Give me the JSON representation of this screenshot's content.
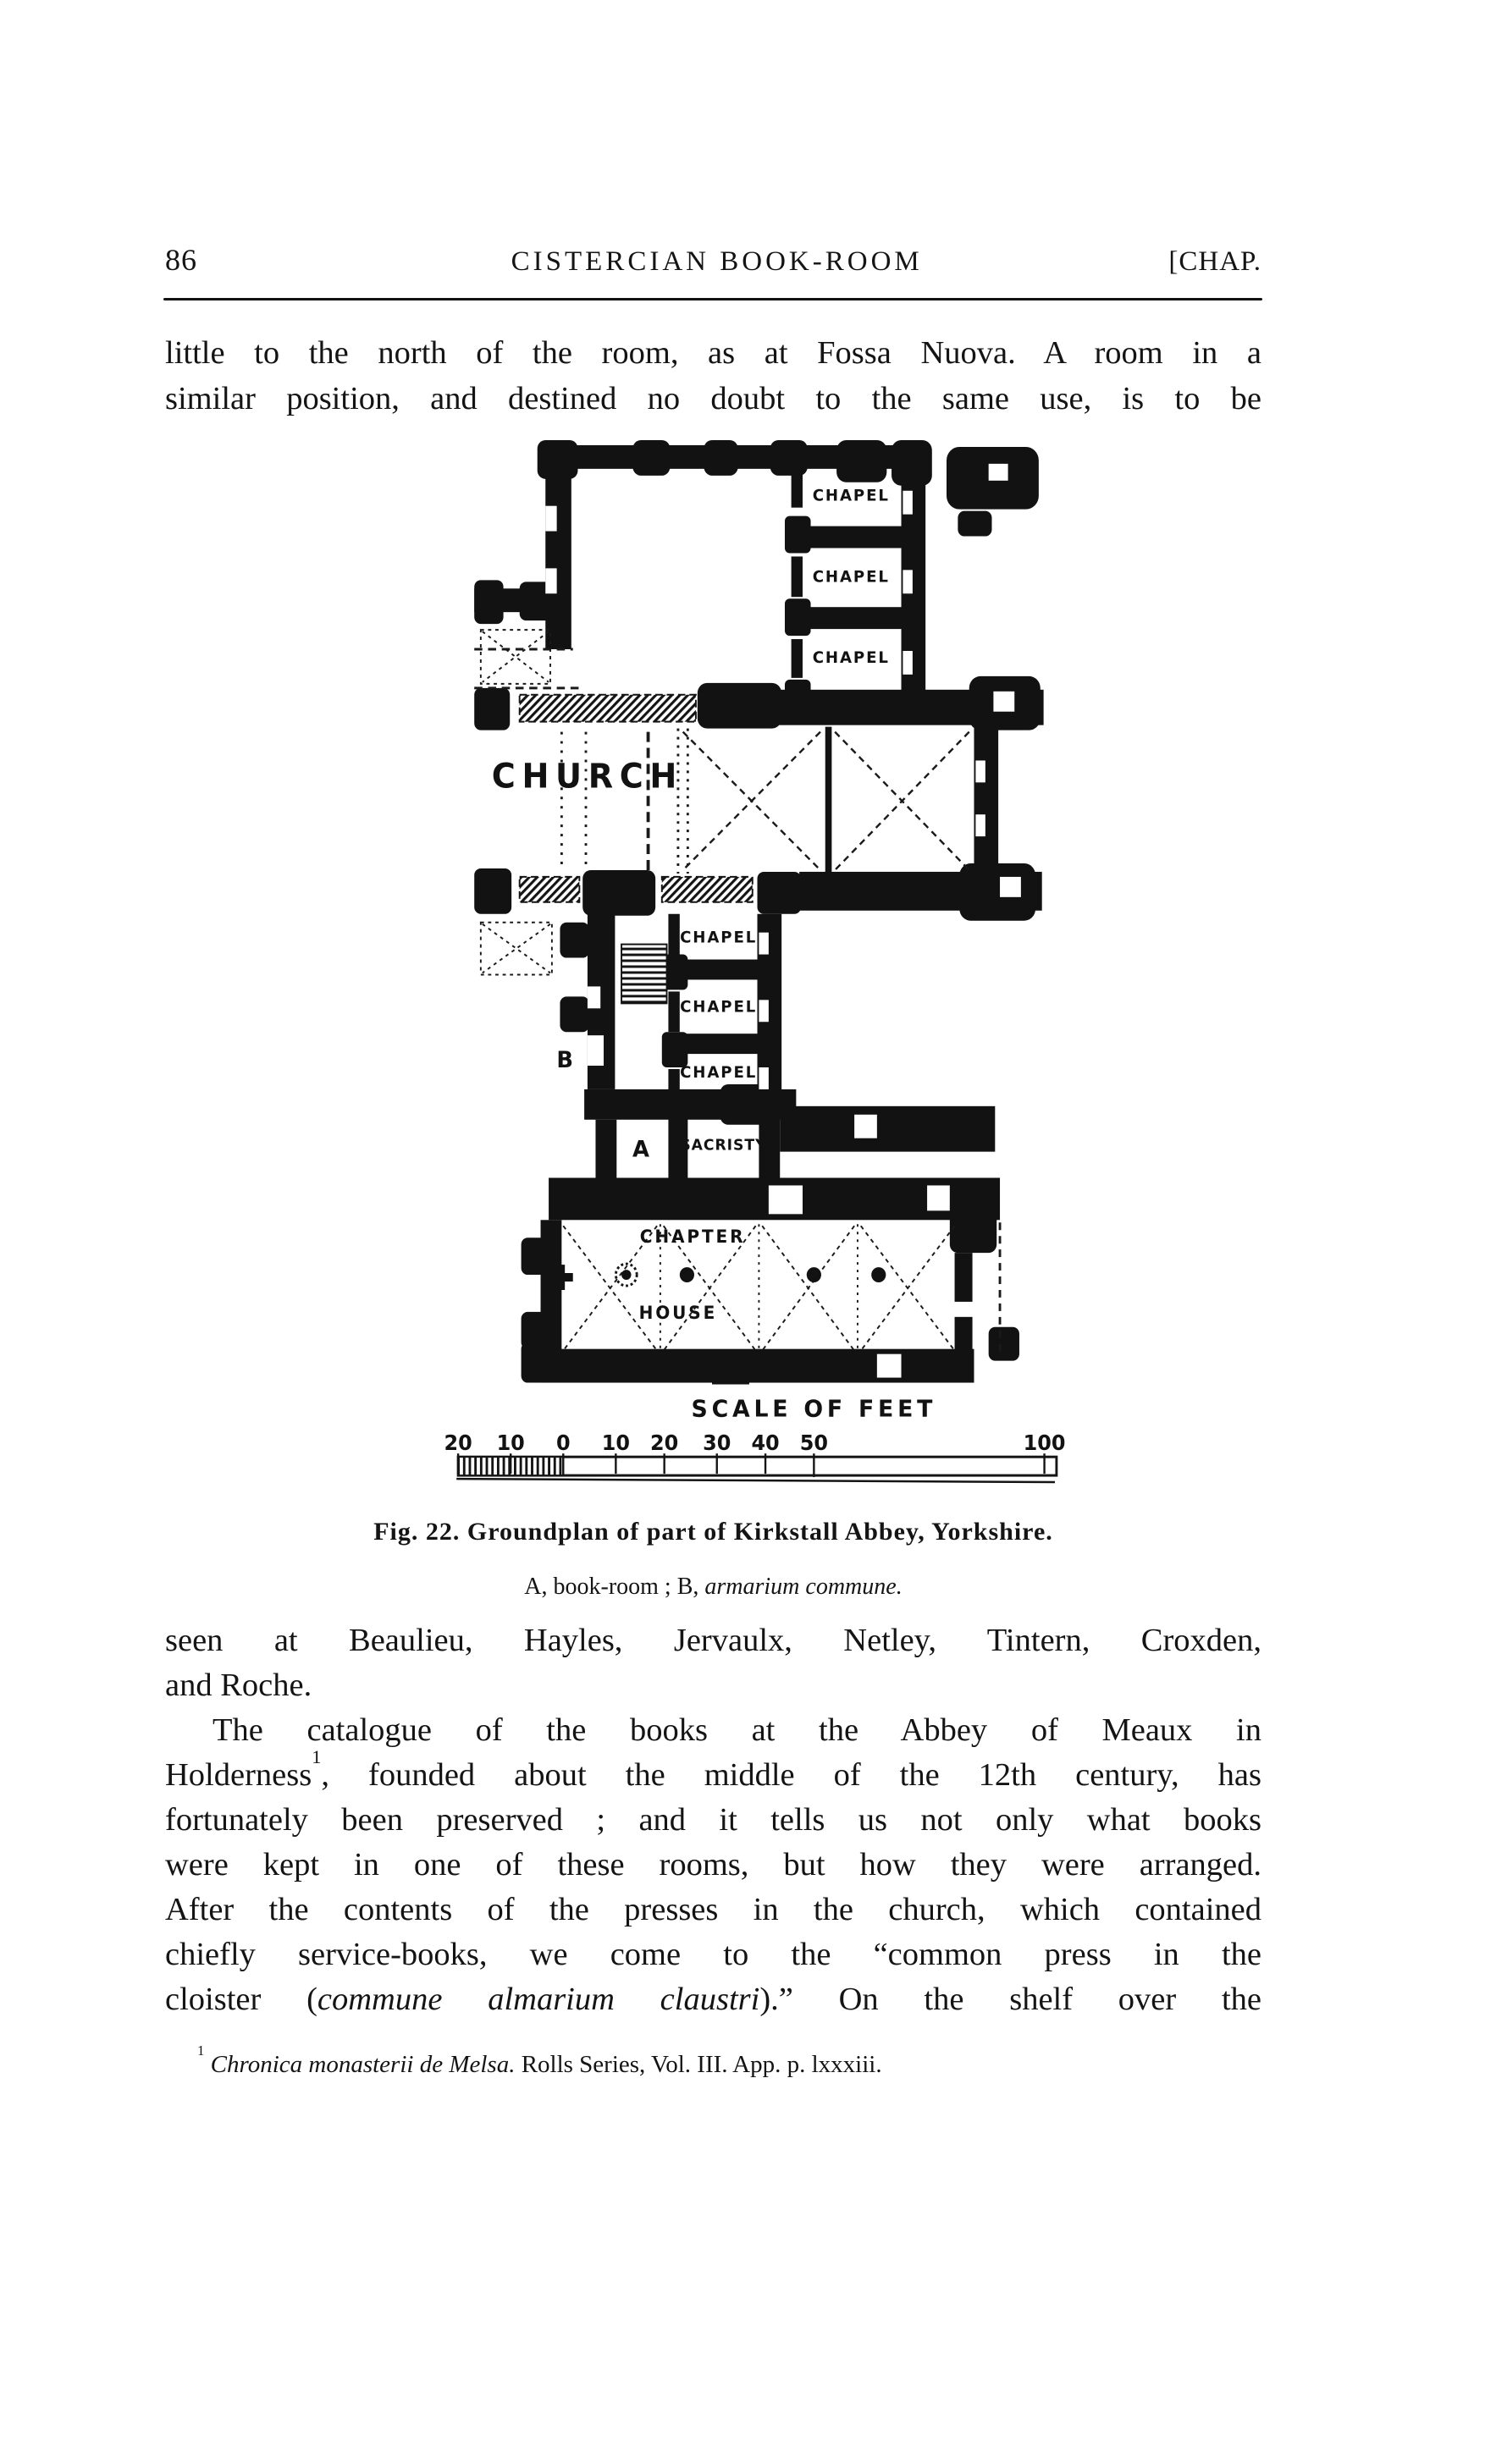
{
  "header": {
    "page_number": "86",
    "title": "CISTERCIAN BOOK-ROOM",
    "chapter_mark": "[CHAP."
  },
  "intro": {
    "lines": [
      {
        "justify": true,
        "seg": [
          {
            "t": "little to the north of the room, as at Fossa Nuova.  A room in a"
          }
        ]
      },
      {
        "justify": true,
        "seg": [
          {
            "t": "similar position, and destined no doubt to the same use, is to be"
          }
        ]
      }
    ]
  },
  "figure": {
    "plan": {
      "church": "CHURCH",
      "chapels": [
        "CHAPEL",
        "CHAPEL",
        "CHAPEL",
        "CHAPEL",
        "CHAPEL",
        "CHAPEL"
      ],
      "sacristy": "SACRISTY",
      "chapter_word1": "CHAPTER",
      "chapter_word2": "HOUSE",
      "room_a": "A",
      "room_b": "B"
    },
    "scale": {
      "title": "SCALE OF FEET",
      "ticks": [
        "20",
        "10",
        "0",
        "10",
        "20",
        "30",
        "40",
        "50",
        "100"
      ]
    },
    "caption_line1": "Fig. 22.  Groundplan of part of Kirkstall Abbey, Yorkshire.",
    "caption_line2": {
      "lines": [
        {
          "seg": [
            {
              "t": "A, book-room ;  B, "
            },
            {
              "t": "armarium commune.",
              "s": "i"
            }
          ]
        }
      ]
    }
  },
  "body": {
    "lines": [
      {
        "justify": true,
        "seg": [
          {
            "t": "seen at Beaulieu, Hayles, Jervaulx, Netley, Tintern, Croxden,"
          }
        ]
      },
      {
        "justify": false,
        "seg": [
          {
            "t": "and Roche."
          }
        ]
      },
      {
        "justify": true,
        "indent": true,
        "seg": [
          {
            "t": "The catalogue of the books at the Abbey of Meaux in"
          }
        ]
      },
      {
        "justify": true,
        "seg": [
          {
            "t": "Holderness"
          },
          {
            "t": "1",
            "s": "sup"
          },
          {
            "t": ", founded about the middle of the 12th century, has"
          }
        ]
      },
      {
        "justify": true,
        "seg": [
          {
            "t": "fortunately been preserved ; and it tells us not only what books"
          }
        ]
      },
      {
        "justify": true,
        "seg": [
          {
            "t": "were kept in one of these rooms, but how they were arranged."
          }
        ]
      },
      {
        "justify": true,
        "seg": [
          {
            "t": "After the contents of the presses in the church, which contained"
          }
        ]
      },
      {
        "justify": true,
        "seg": [
          {
            "t": "chiefly service-books, we come to the “common press in the"
          }
        ]
      },
      {
        "justify": true,
        "seg": [
          {
            "t": "cloister ("
          },
          {
            "t": "commune almarium claustri",
            "s": "i"
          },
          {
            "t": ").”  On the shelf over the"
          }
        ]
      }
    ]
  },
  "footnote": {
    "lines": [
      {
        "seg": [
          {
            "t": "1",
            "s": "sup"
          },
          {
            "t": " "
          },
          {
            "t": "Chronica monasterii de Melsa.",
            "s": "i"
          },
          {
            "t": "  Rolls Series, Vol. III. App. p. lxxxiii."
          }
        ]
      }
    ]
  }
}
